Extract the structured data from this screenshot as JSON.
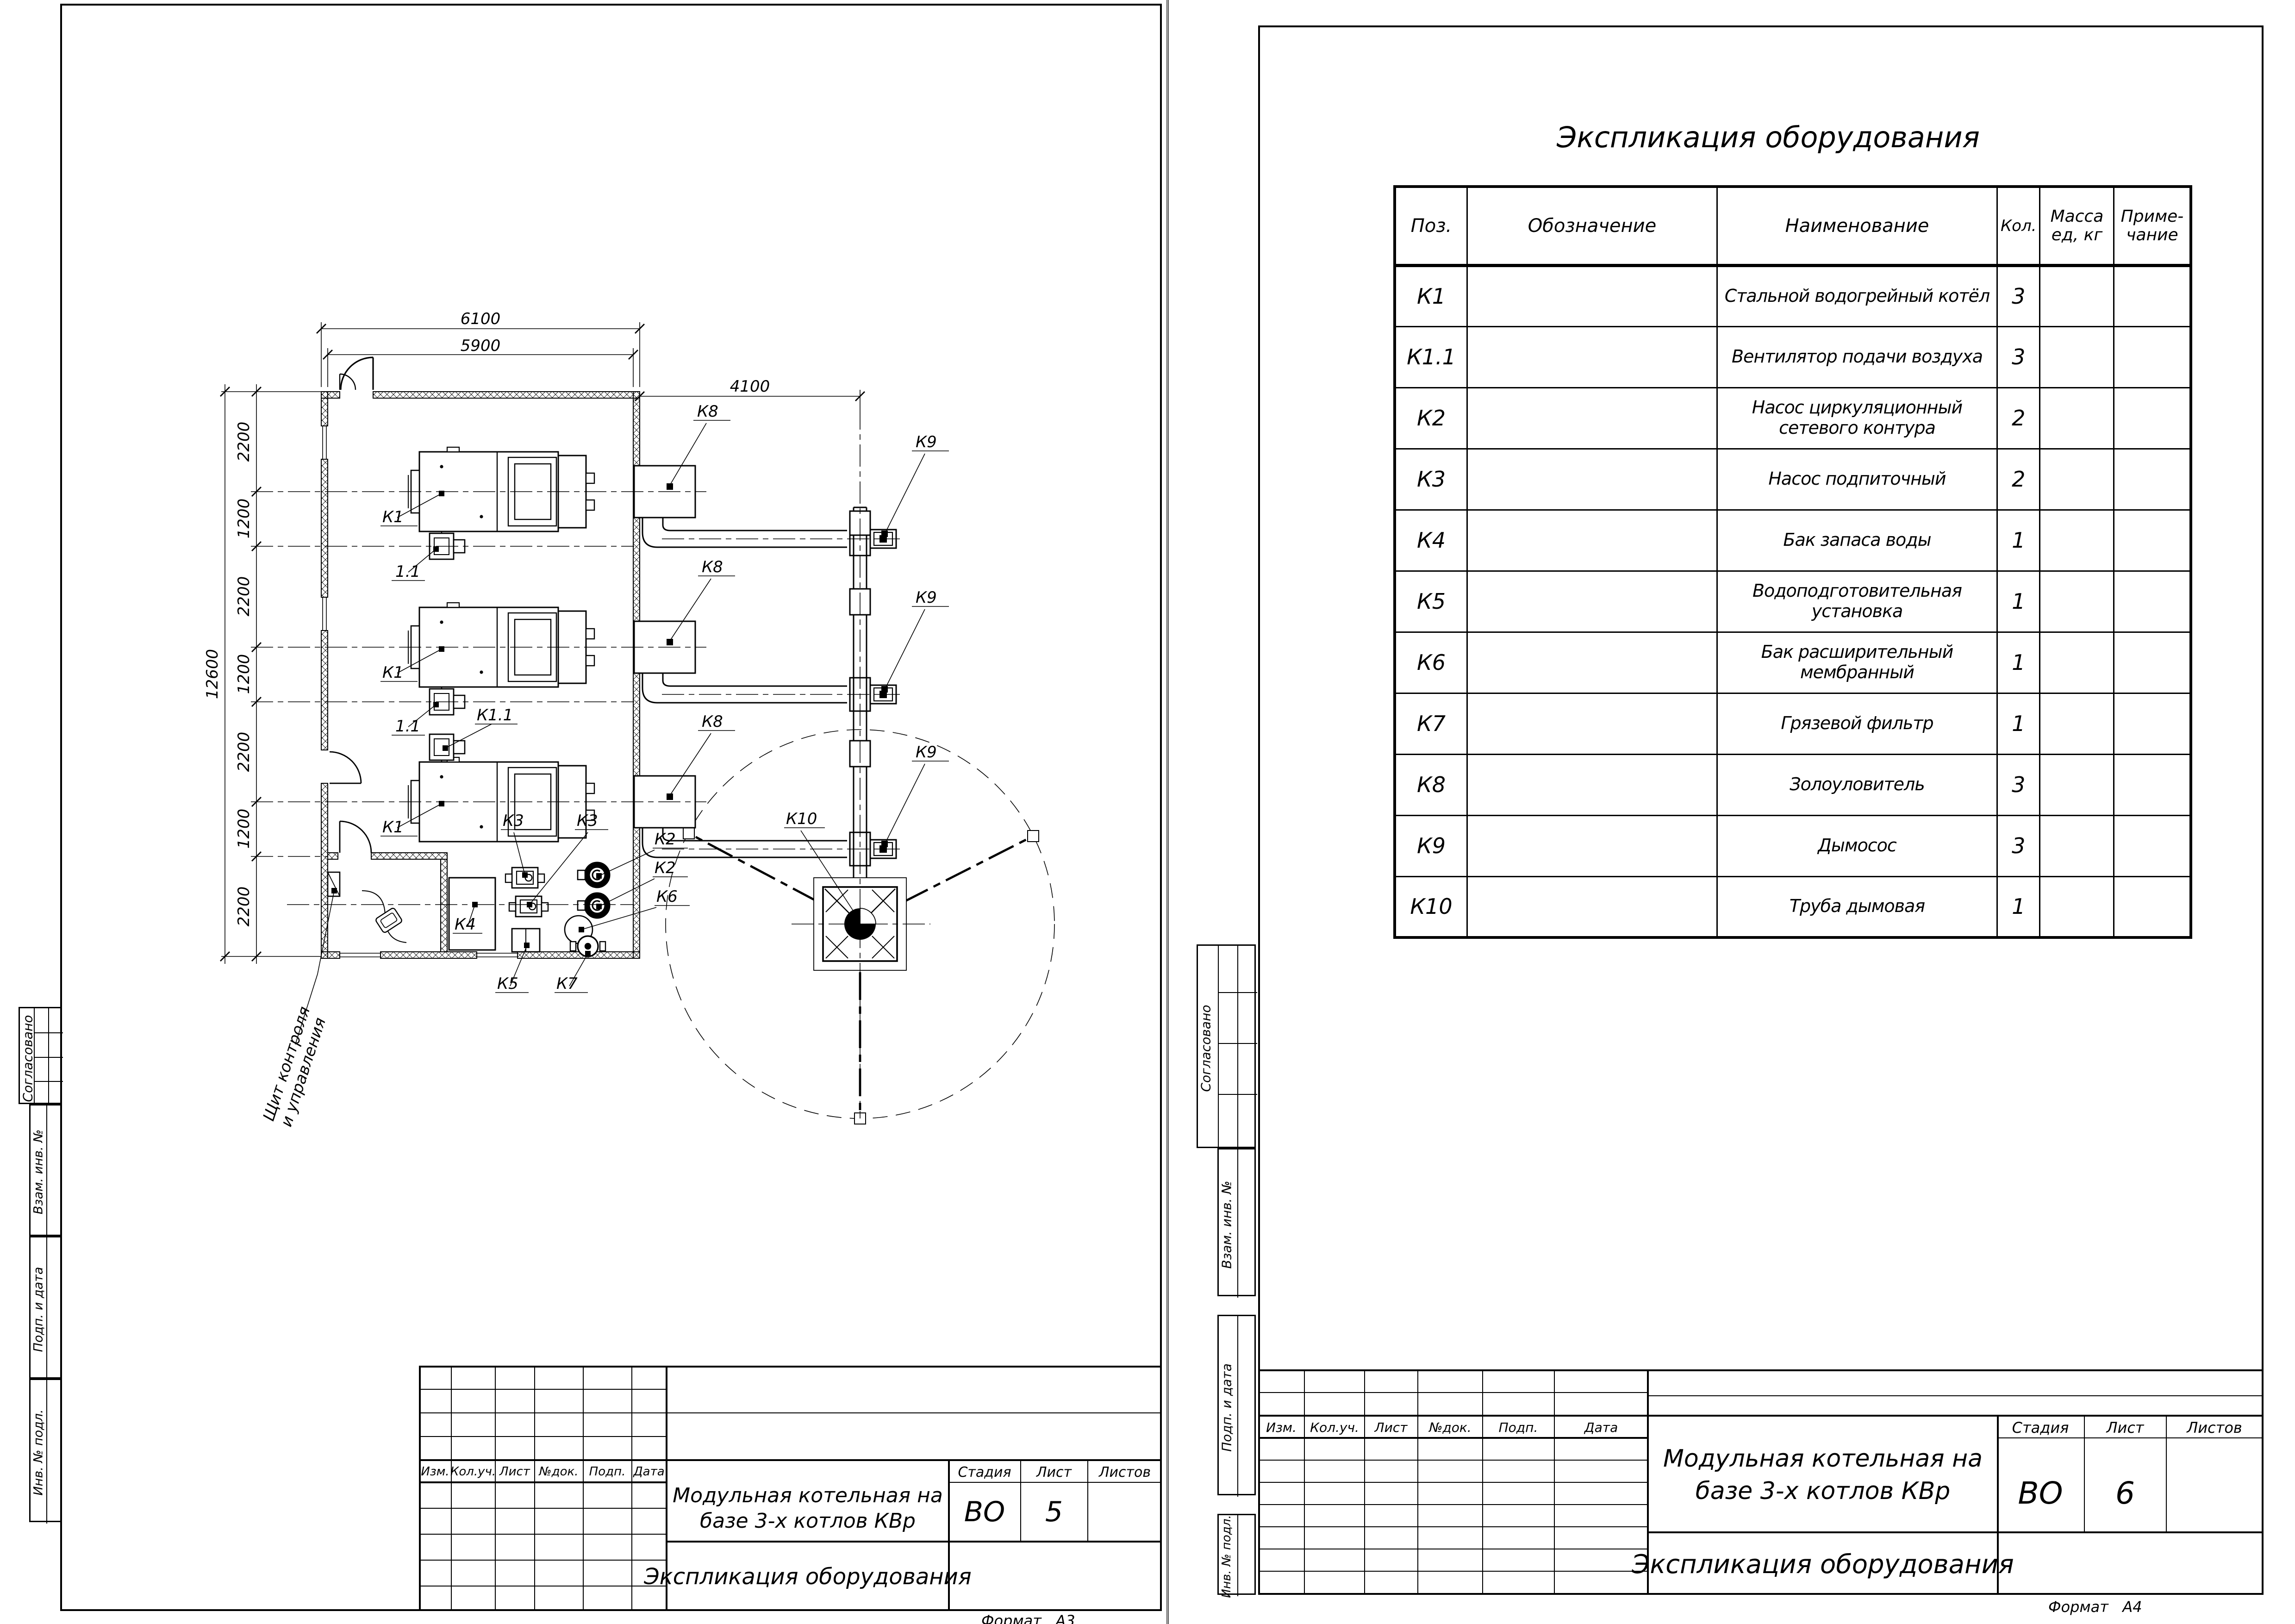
{
  "left_sheet": {
    "stamps": {
      "agreed": "Согласовано",
      "replace_inv": "Взам. инв. №",
      "sign_date": "Подп. и дата",
      "inv_orig": "Инв. № подл."
    },
    "plan": {
      "dims": {
        "top_outer": "6100",
        "top_inner": "5900",
        "flue": "4100",
        "overall_left": "12600",
        "left_segments": [
          "2200",
          "1200",
          "2200",
          "1200",
          "2200",
          "1200",
          "2200"
        ]
      },
      "tags": {
        "k1": "К1",
        "k11_short": "1.1",
        "k11": "К1.1",
        "k2": "К2",
        "k3": "К3",
        "k4": "К4",
        "k5": "К5",
        "k6": "К6",
        "k7": "К7",
        "k8": "К8",
        "k9": "К9",
        "k10": "К10"
      },
      "panel_label_1": "Щит контроля",
      "panel_label_2": "и управления"
    },
    "title_block": {
      "rev_headers": [
        "Изм.",
        "Кол.уч.",
        "Лист",
        "№док.",
        "Подп.",
        "Дата"
      ],
      "project_line1": "Модульная котельная на",
      "project_line2": "базе 3-х котлов КВр",
      "stage_label": "Стадия",
      "sheet_label": "Лист",
      "sheets_label": "Листов",
      "stage": "ВО",
      "sheet": "5",
      "doc_title": "Экспликация оборудования",
      "format_label": "Формат",
      "format_value": "А3"
    }
  },
  "right_sheet": {
    "stamps": {
      "agreed": "Согласовано",
      "replace_inv": "Взам. инв. №",
      "sign_date": "Подп. и дата",
      "inv_orig": "Инв. № подл."
    },
    "table": {
      "title": "Экспликация оборудования",
      "headers": {
        "pos": "Поз.",
        "designation": "Обозначение",
        "name": "Наименование",
        "qty": "Кол.",
        "mass_1": "Масса",
        "mass_2": "ед, кг",
        "note_1": "Приме-",
        "note_2": "чание"
      },
      "rows": [
        {
          "pos": "К1",
          "designation": "",
          "name": "Стальной водогрейный котёл",
          "qty": "3",
          "mass": "",
          "note": ""
        },
        {
          "pos": "К1.1",
          "designation": "",
          "name": "Вентилятор подачи воздуха",
          "qty": "3",
          "mass": "",
          "note": ""
        },
        {
          "pos": "К2",
          "designation": "",
          "name": "Насос циркуляционный\nсетевого контура",
          "qty": "2",
          "mass": "",
          "note": ""
        },
        {
          "pos": "К3",
          "designation": "",
          "name": "Насос подпиточный",
          "qty": "2",
          "mass": "",
          "note": ""
        },
        {
          "pos": "К4",
          "designation": "",
          "name": "Бак запаса воды",
          "qty": "1",
          "mass": "",
          "note": ""
        },
        {
          "pos": "К5",
          "designation": "",
          "name": "Водоподготовительная установка",
          "qty": "1",
          "mass": "",
          "note": ""
        },
        {
          "pos": "К6",
          "designation": "",
          "name": "Бак расширительный мембранный",
          "qty": "1",
          "mass": "",
          "note": ""
        },
        {
          "pos": "К7",
          "designation": "",
          "name": "Грязевой фильтр",
          "qty": "1",
          "mass": "",
          "note": ""
        },
        {
          "pos": "К8",
          "designation": "",
          "name": "Золоуловитель",
          "qty": "3",
          "mass": "",
          "note": ""
        },
        {
          "pos": "К9",
          "designation": "",
          "name": "Дымосос",
          "qty": "3",
          "mass": "",
          "note": ""
        },
        {
          "pos": "К10",
          "designation": "",
          "name": "Труба дымовая",
          "qty": "1",
          "mass": "",
          "note": ""
        }
      ]
    },
    "title_block": {
      "rev_headers": [
        "Изм.",
        "Кол.уч.",
        "Лист",
        "№док.",
        "Подп.",
        "Дата"
      ],
      "project_line1": "Модульная котельная на",
      "project_line2": "базе 3-х котлов КВр",
      "stage_label": "Стадия",
      "sheet_label": "Лист",
      "sheets_label": "Листов",
      "stage": "ВО",
      "sheet": "6",
      "doc_title": "Экспликация оборудования",
      "format_label": "Формат",
      "format_value": "А4"
    }
  }
}
